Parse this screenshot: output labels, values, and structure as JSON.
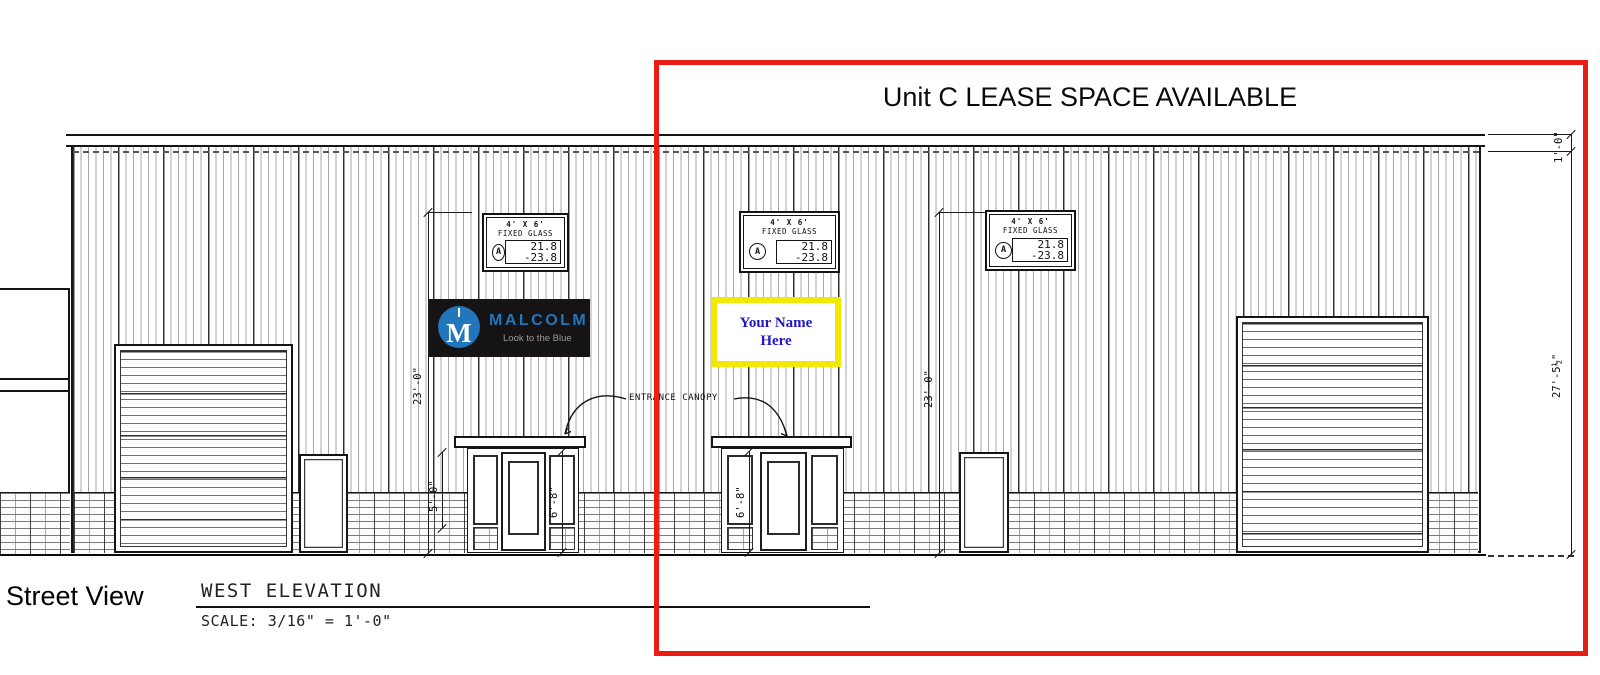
{
  "banner": {
    "text": "Unit C LEASE SPACE AVAILABLE"
  },
  "titleblock": {
    "street_view": "Street View",
    "title": "WEST ELEVATION",
    "scale": "SCALE: 3/16\" = 1'-0\""
  },
  "labels": {
    "entrance_canopy": "ENTRANCE CANOPY"
  },
  "signs": {
    "malcolm": {
      "name": "MALCOLM",
      "tagline": "Look to the Blue",
      "logo_letter": "M"
    },
    "placeholder": {
      "line1": "Your Name",
      "line2": "Here"
    }
  },
  "callouts": {
    "windows": [
      {
        "size": "4' X 6'",
        "glazing": "FIXED GLASS",
        "tag": "A",
        "elev_top": "21.8",
        "elev_bottom": "-23.8"
      },
      {
        "size": "4' X 6'",
        "glazing": "FIXED GLASS",
        "tag": "A",
        "elev_top": "21.8",
        "elev_bottom": "-23.8"
      },
      {
        "size": "4' X 6'",
        "glazing": "FIXED GLASS",
        "tag": "A",
        "elev_top": "21.8",
        "elev_bottom": "-23.8"
      }
    ]
  },
  "dimensions": {
    "eave": "1'-0\"",
    "overall_height": "27'-5½\"",
    "bay_left": "23'-0\"",
    "bay_right": "23'-0\"",
    "sidelite_height": "5'-0\"",
    "door_left": "6'-8\"",
    "door_right": "6'-8\""
  },
  "colors": {
    "highlight_red": "#e91c16",
    "sign_yellow": "#f3e800",
    "sign_text_blue": "#2018c8",
    "malcolm_blue": "#2176bc",
    "malcolm_bg": "#151313",
    "tagline_gray": "#9a9a9a"
  }
}
